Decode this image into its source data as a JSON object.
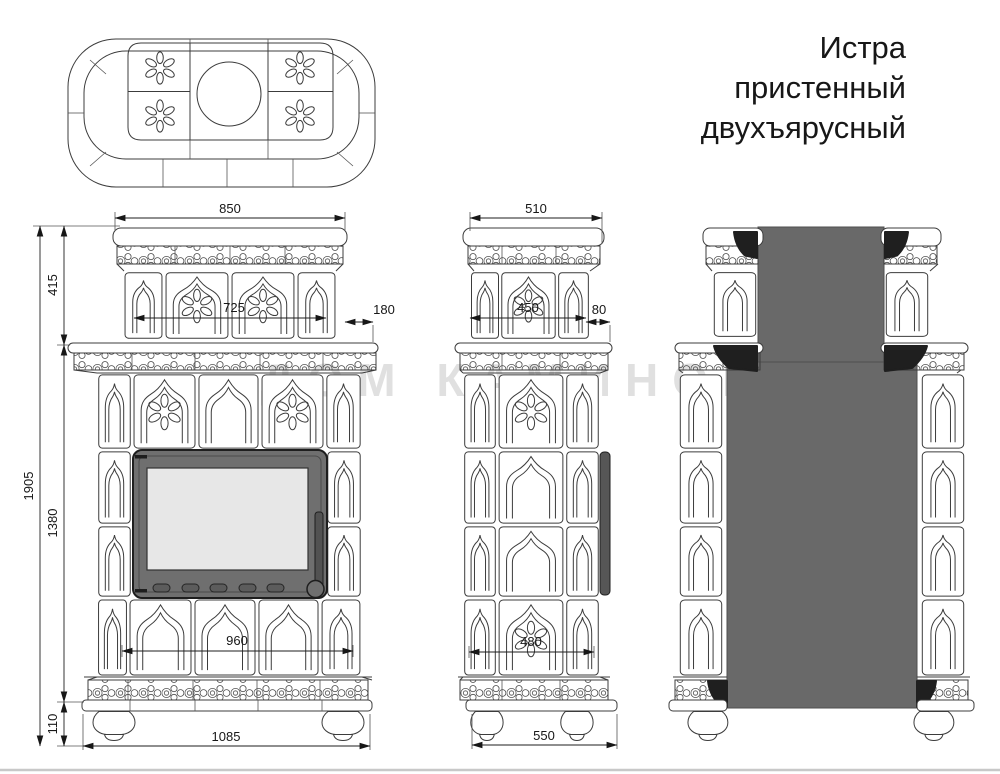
{
  "title": {
    "lines": [
      "Истра",
      "пристенный",
      "двухъярусный"
    ]
  },
  "watermark": "ДОМ КАМИНОВ",
  "drawing": {
    "subject": "tiled-stove-technical-drawing",
    "views": [
      "top-plan",
      "front",
      "side",
      "rear"
    ]
  },
  "dimensions": {
    "front": {
      "upper_width": "850",
      "tier_height": "415",
      "upper_body_width": "725",
      "rear_offset": "180",
      "total_height": "1905",
      "body_height": "1380",
      "lower_body_width": "960",
      "plinth_height": "110",
      "base_width": "1085"
    },
    "side": {
      "upper_width": "510",
      "upper_body_width": "450",
      "rear_offset": "80",
      "lower_body_width": "480",
      "base_width": "550"
    }
  },
  "colors": {
    "masonry_gray": "#696969",
    "dark_accent": "#1f1f1f",
    "door_body": "#6f6f6f",
    "door_glass": "#e7e7e7",
    "line": "#3c3c3c",
    "page_edge": "#c8c8c8"
  }
}
